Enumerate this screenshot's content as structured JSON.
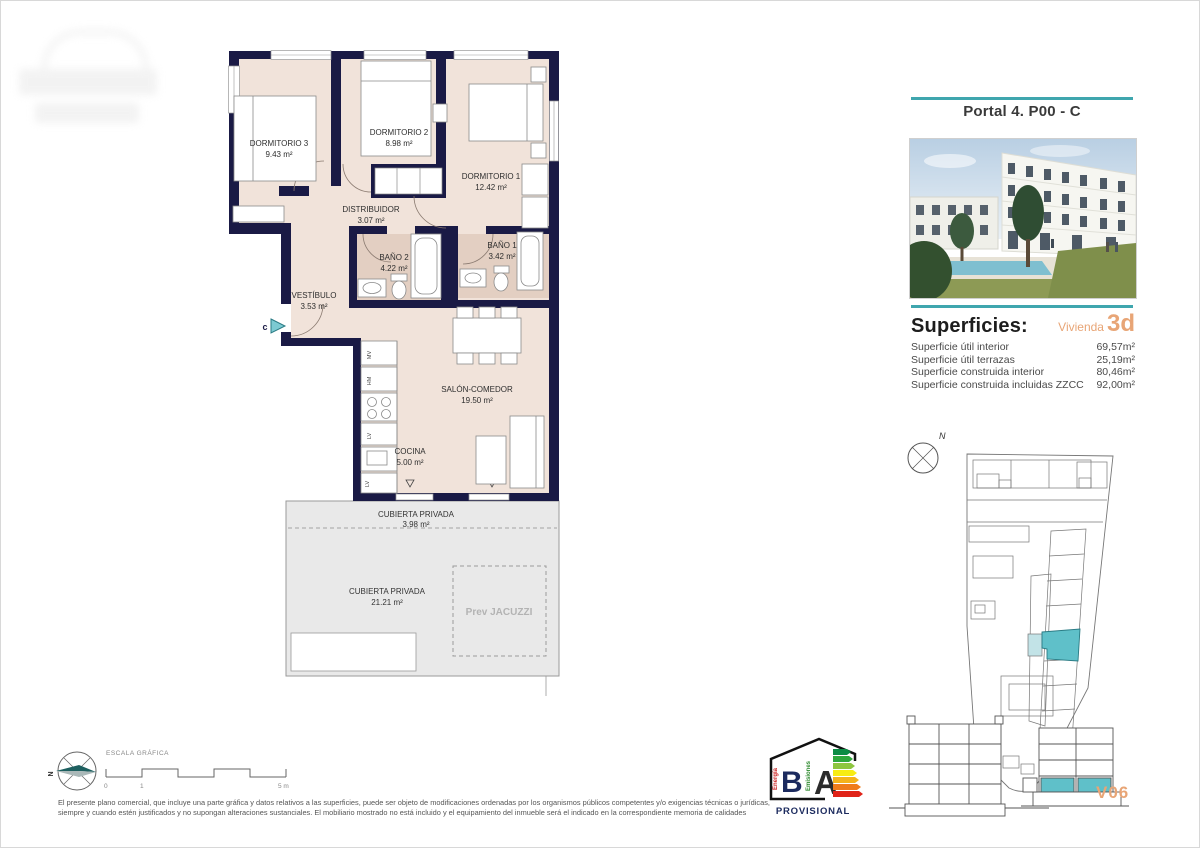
{
  "header": {
    "title": "Portal 4. P00 - C"
  },
  "superficies": {
    "heading": "Superficies:",
    "vivienda_label": "Vivienda",
    "vivienda_code": "3d",
    "rows": [
      {
        "label": "Superficie útil interior",
        "value": "69,57m²"
      },
      {
        "label": "Superficie útil terrazas",
        "value": "25,19m²"
      },
      {
        "label": "Superficie construida interior",
        "value": "80,46m²"
      },
      {
        "label": "Superficie construida incluidas ZZCC",
        "value": "92,00m²"
      }
    ]
  },
  "floor_plan": {
    "rooms": {
      "d3": {
        "name": "DORMITORIO 3",
        "area": "9.43 m²"
      },
      "d2": {
        "name": "DORMITORIO 2",
        "area": "8.98 m²"
      },
      "d1": {
        "name": "DORMITORIO 1",
        "area": "12.42 m²"
      },
      "distribuidor": {
        "name": "DISTRIBUIDOR",
        "area": "3.07 m²"
      },
      "bano2": {
        "name": "BAÑO 2",
        "area": "4.22 m²"
      },
      "bano1": {
        "name": "BAÑO 1",
        "area": "3.42 m²"
      },
      "vestibulo": {
        "name": "VESTÍBULO",
        "area": "3.53 m²"
      },
      "salon": {
        "name": "SALÓN-COMEDOR",
        "area": "19.50 m²"
      },
      "cocina": {
        "name": "COCINA",
        "area": "5.00 m²"
      },
      "terraza_sup": {
        "name": "CUBIERTA PRIVADA",
        "area": "3.98 m²"
      },
      "terraza": {
        "name": "CUBIERTA PRIVADA",
        "area": "21.21 m²"
      }
    },
    "jacuzzi_label": "Prev JACUZZI",
    "entrance_label": "c",
    "kitchen_labels": [
      "MV",
      "HM",
      "LV",
      "LV"
    ]
  },
  "scale_bar": {
    "label": "ESCALA GRÁFICA",
    "tick_start": "0",
    "tick_one": "1",
    "tick_end": "5 m",
    "north_label": "N"
  },
  "site_plan": {
    "north_label": "N"
  },
  "energy_label": {
    "letter_b": "B",
    "letter_a": "A",
    "energia": "Energía",
    "emisiones": "Emisiones",
    "status": "PROVISIONAL"
  },
  "footer": {
    "line1": "El presente plano comercial, que incluye una parte gráfica y datos relativos a las superficies, puede ser objeto de modificaciones ordenadas por los organismos públicos competentes y/o exigencias técnicas o jurídicas,",
    "line2": "siempre y cuando estén justificados y no supongan alteraciones sustanciales. El mobiliario mostrado no está incluido y el equipamiento del inmueble será el indicado en la correspondiente memoria de calidades"
  },
  "version_code": "V06",
  "colors": {
    "accent_teal": "#3fa6ae",
    "accent_orange": "#e8a576",
    "wall_navy": "#1a1a45",
    "floor_beige": "#f1e3da",
    "bath_beige": "#e3cfc2",
    "terrace_gray": "#e9e9e9",
    "highlight_teal": "#5fc0c9"
  }
}
